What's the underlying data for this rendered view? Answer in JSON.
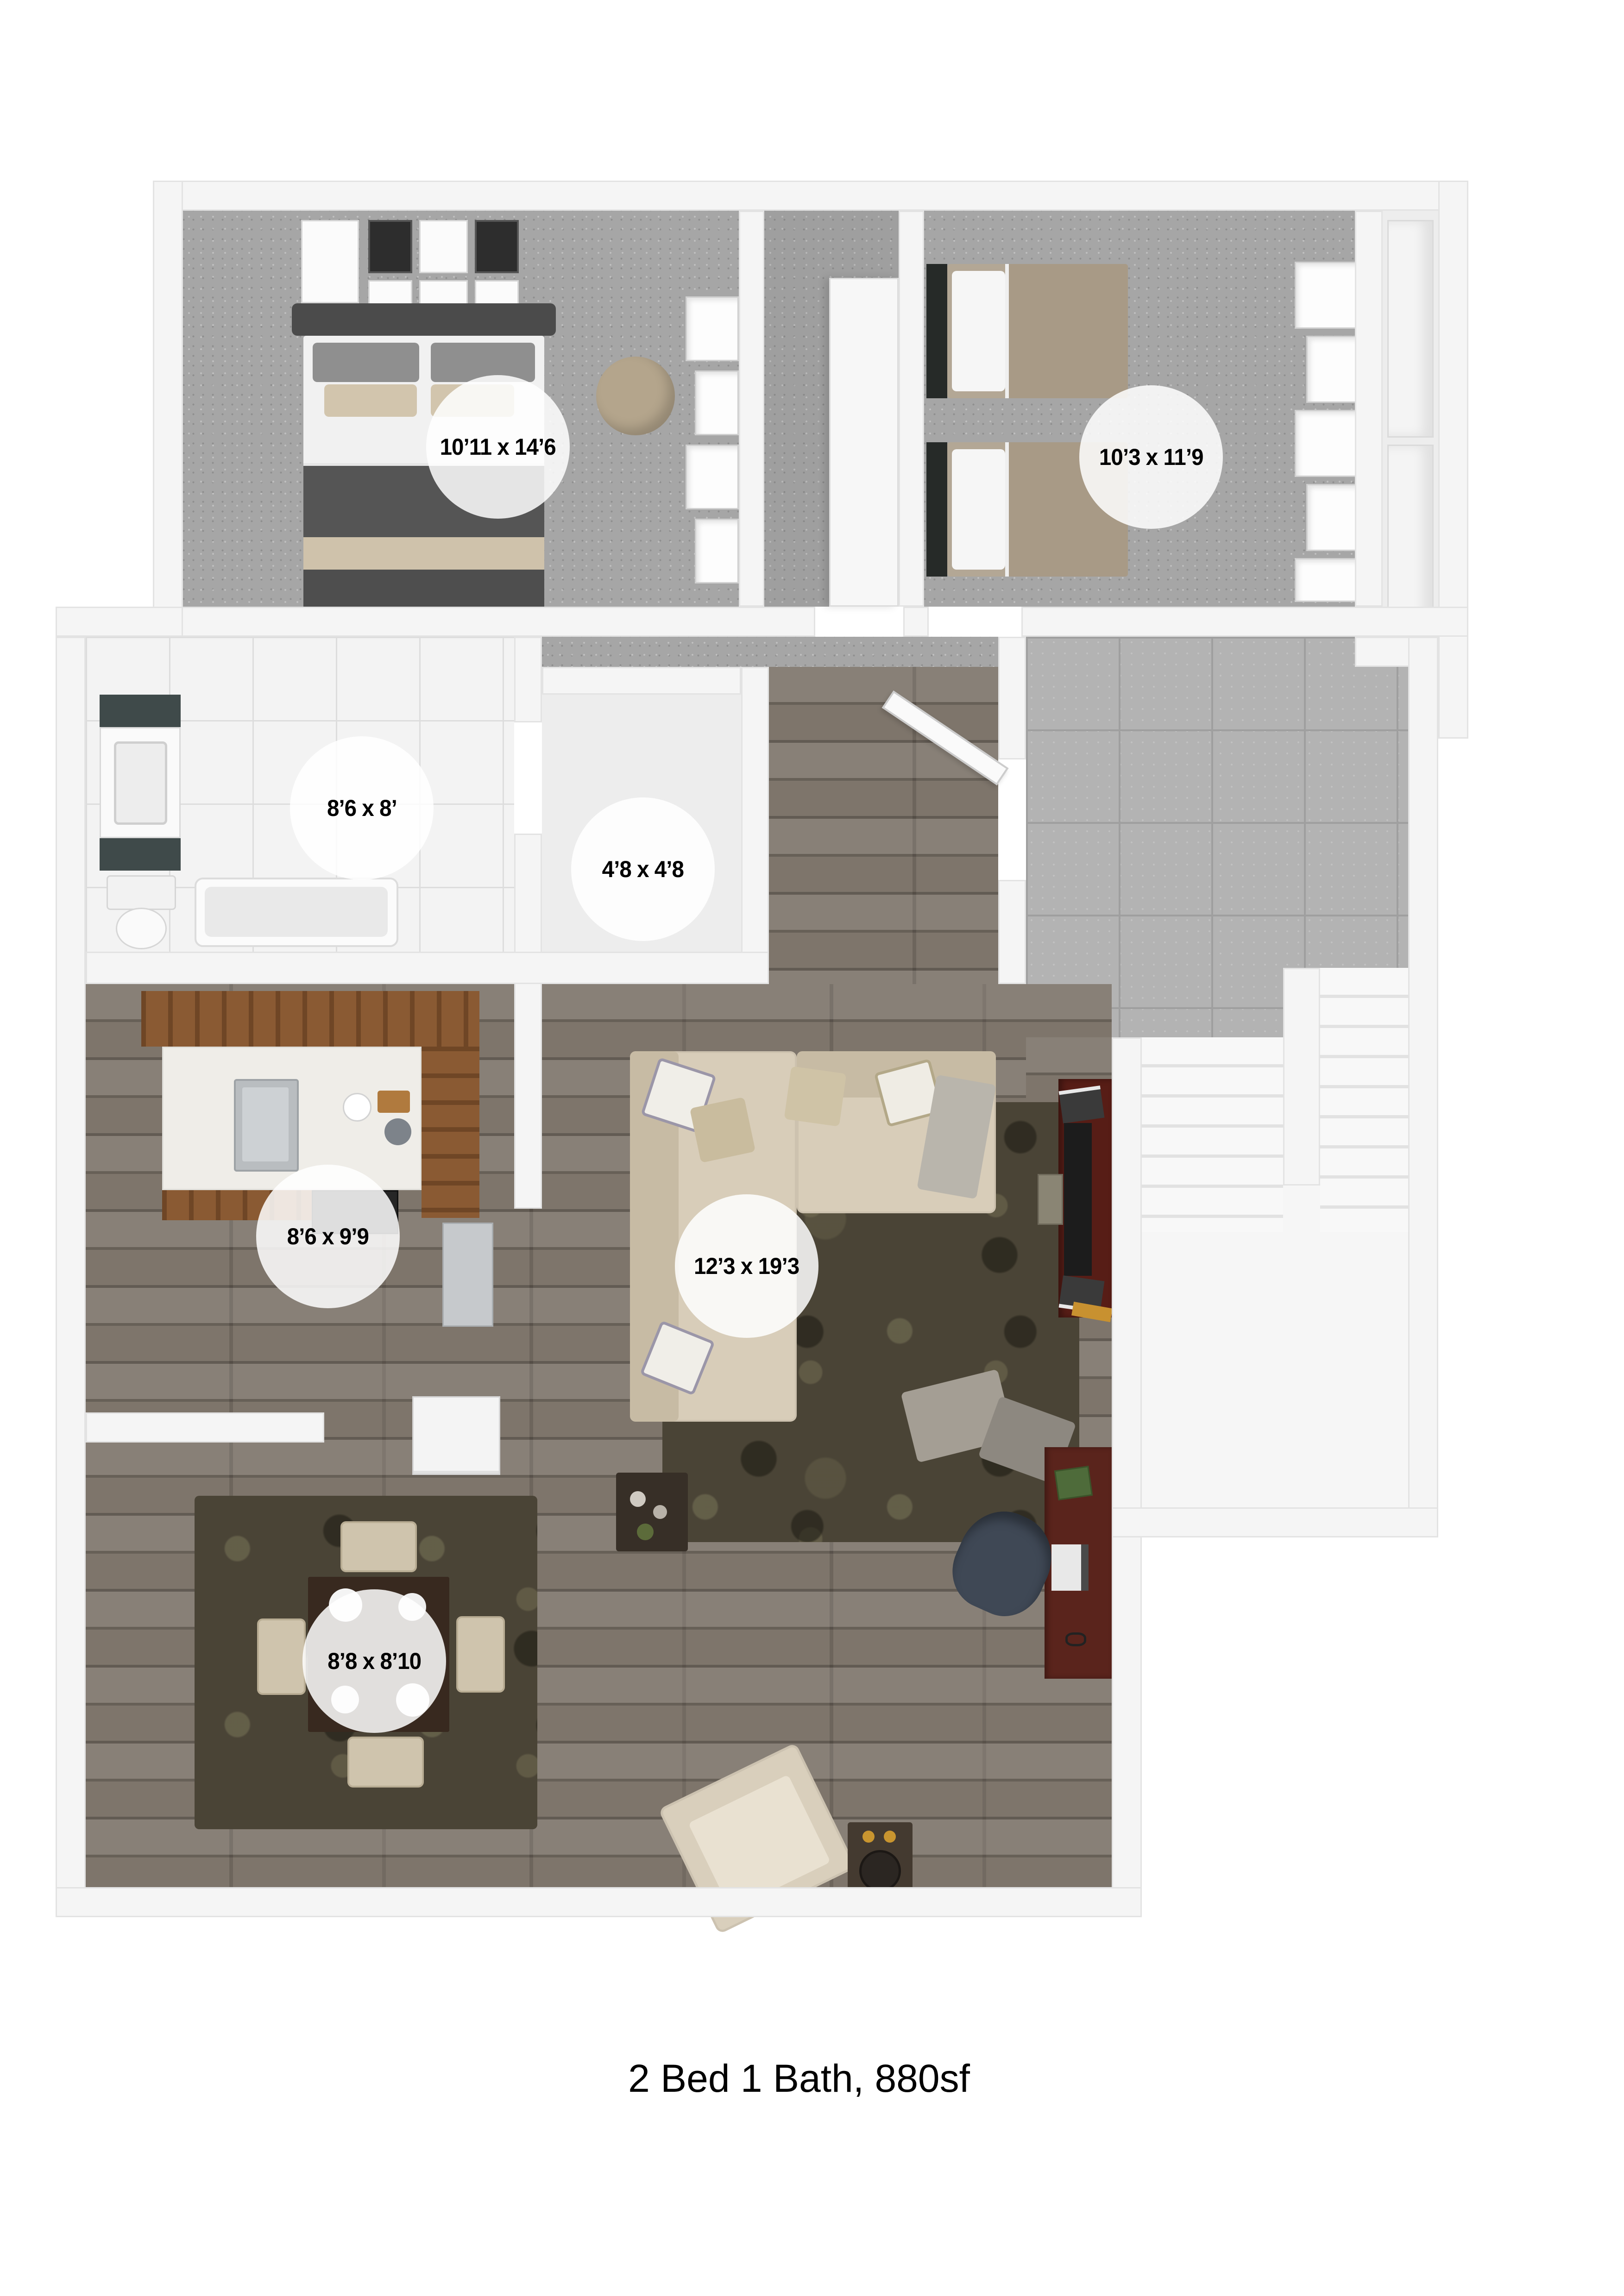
{
  "caption": "2 Bed 1 Bath, 880sf",
  "rooms": {
    "bedroom1": {
      "label": "10’11 x 14’6"
    },
    "bedroom2": {
      "label": "10’3 x 11’9"
    },
    "bathroom": {
      "label": "8’6 x 8’"
    },
    "closet": {
      "label": "4’8 x 4’8"
    },
    "kitchen": {
      "label": "8’6 x 9’9"
    },
    "living_room": {
      "label": "12’3 x 19’3"
    },
    "dining_area": {
      "label": "8’8 x 8’10"
    }
  },
  "style": {
    "wall_color": "#f5f5f5",
    "carpet_color": "#a6a6a6",
    "wood_floor_color": "#7b7268",
    "bath_tile_color": "#f3f3f3",
    "rug_color": "#4a4436",
    "cabinet_wood_color": "#8a5a33",
    "sofa_color": "#d8cdb9",
    "tv_console_color": "#571d16",
    "label_circle_color": "rgba(255,255,255,0.85)",
    "label_text_color": "#000000",
    "caption_color": "#000000"
  }
}
